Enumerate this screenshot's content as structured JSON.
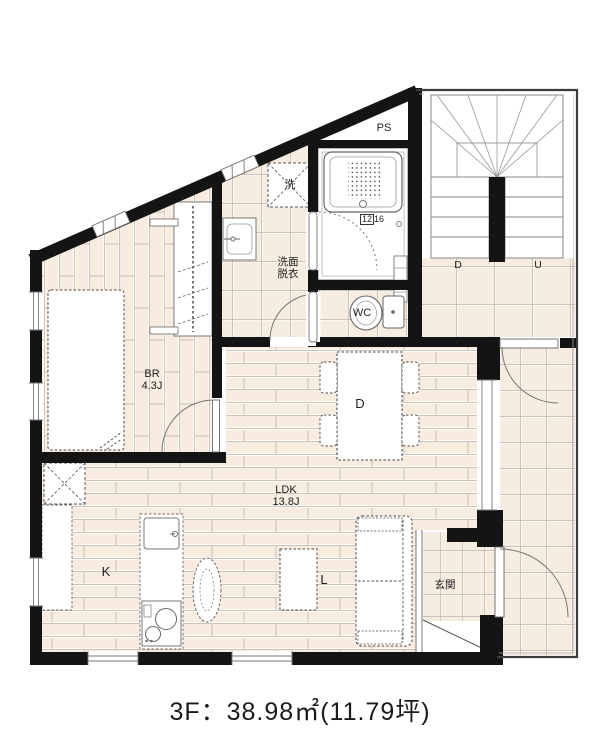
{
  "caption": "3F：38.98㎡(11.79坪)",
  "labels": {
    "pipe_space": "PS",
    "laundry": "洗",
    "bath_size_boxed": "12",
    "bath_size_rest": "16",
    "washroom_line1": "洗面",
    "washroom_line2": "脱衣",
    "wc": "WC",
    "bedroom_line1": "BR",
    "bedroom_line2": "4.3J",
    "dining": "D",
    "ldk_line1": "LDK",
    "ldk_line2": "13.8J",
    "kitchen": "K",
    "living": "L",
    "entrance": "玄関",
    "stair_down": "D",
    "stair_up": "U"
  },
  "colors": {
    "wall": "#141414",
    "floor": "#f7ecdf",
    "floor_line": "#b9afa3",
    "fixture_stroke": "#666666"
  }
}
